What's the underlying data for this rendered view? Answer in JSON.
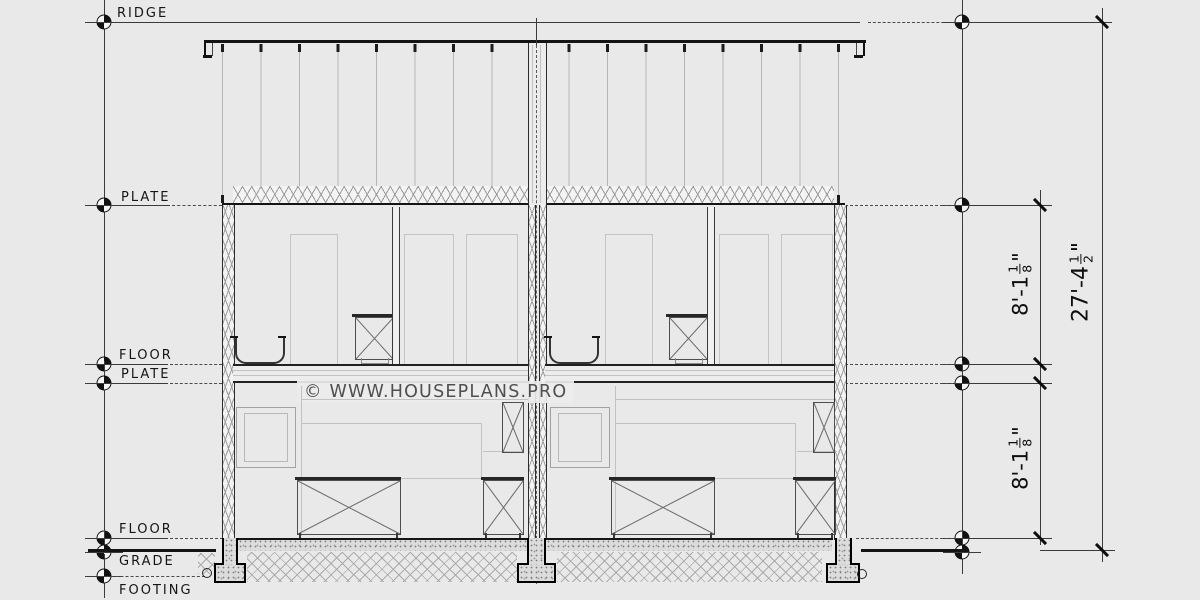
{
  "drawing": {
    "title_hint": "duplex building cross section",
    "watermark": "© WWW.HOUSEPLANS.PRO",
    "levels": {
      "ridge": "RIDGE",
      "upper_plate": "PLATE",
      "upper_floor": "FLOOR",
      "main_plate": "PLATE",
      "main_floor": "FLOOR",
      "grade": "GRADE",
      "footing": "FOOTING"
    },
    "dimensions": {
      "upper_story_height": {
        "prefix": "8'-1",
        "numerator": "1",
        "denominator": "8",
        "suffix": "\""
      },
      "main_story_height": {
        "prefix": "8'-1",
        "numerator": "1",
        "denominator": "8",
        "suffix": "\""
      },
      "overall_height": {
        "prefix": "27'-4",
        "numerator": "1",
        "denominator": "2",
        "suffix": "\""
      }
    },
    "colors": {
      "background": "#e9e9e9",
      "cut_line": "#141414",
      "projection_line": "#c2c2c2",
      "hatch_line": "#9c9c9c",
      "text": "#151515"
    }
  }
}
